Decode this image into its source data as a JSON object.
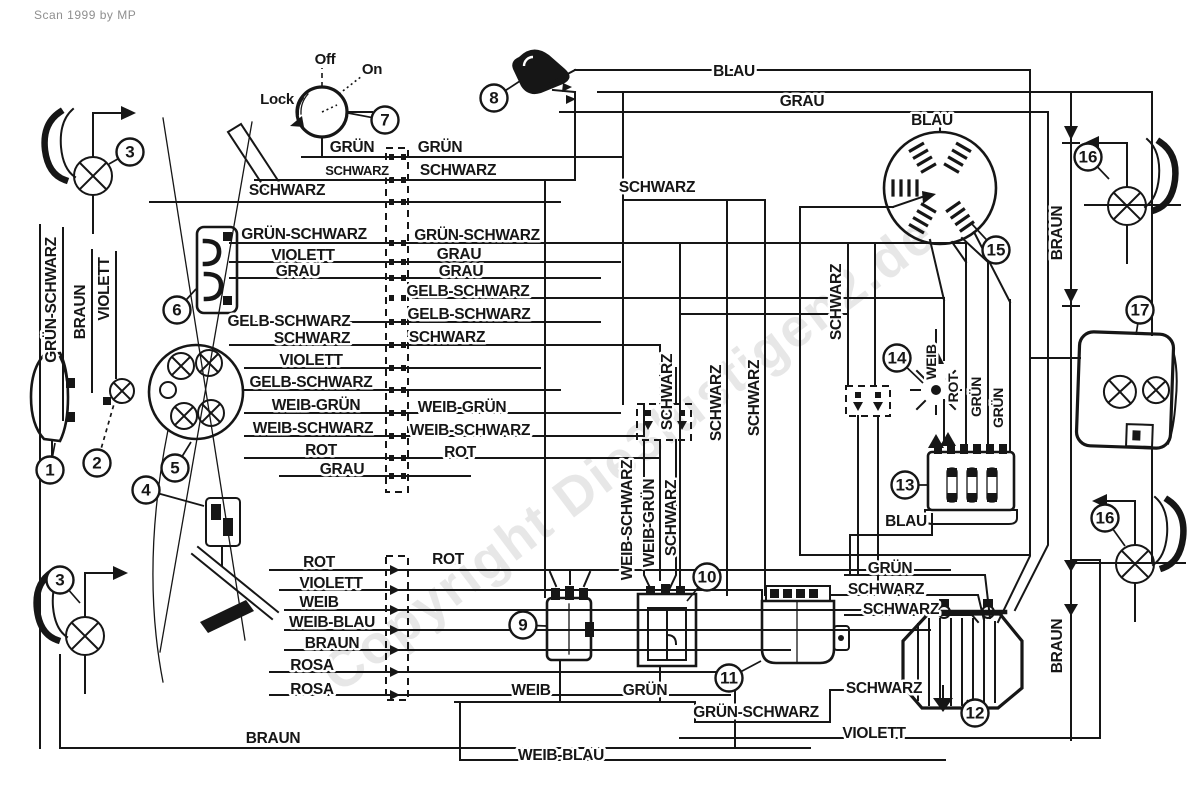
{
  "meta": {
    "credit": "Scan 1999 by MP",
    "watermark": "Copyright Die3lustigen2.de"
  },
  "colors": {
    "ink": "#161616",
    "paper": "#ffffff",
    "watermark": "#bdbdbd"
  },
  "ignition_switch": {
    "positions": [
      "Off",
      "On",
      "Lock"
    ]
  },
  "labels": [
    {
      "text": "Off",
      "x": 325,
      "y": 64,
      "kind": "switch",
      "fs": 15
    },
    {
      "text": "On",
      "x": 372,
      "y": 74,
      "kind": "switch",
      "fs": 15
    },
    {
      "text": "Lock",
      "x": 277,
      "y": 104,
      "kind": "switch",
      "fs": 15
    },
    {
      "text": "GRÜN",
      "x": 352,
      "y": 152
    },
    {
      "text": "GRÜN",
      "x": 440,
      "y": 152
    },
    {
      "text": "SCHWARZ",
      "x": 357,
      "y": 175,
      "fs": 13
    },
    {
      "text": "SCHWARZ",
      "x": 458,
      "y": 175
    },
    {
      "text": "SCHWARZ",
      "x": 287,
      "y": 195
    },
    {
      "text": "BLAU",
      "x": 734,
      "y": 76
    },
    {
      "text": "GRAU",
      "x": 802,
      "y": 106
    },
    {
      "text": "SCHWARZ",
      "x": 657,
      "y": 192
    },
    {
      "text": "BLAU",
      "x": 932,
      "y": 125
    },
    {
      "text": "GRÜN-SCHWARZ",
      "x": 304,
      "y": 239
    },
    {
      "text": "GRÜN-SCHWARZ",
      "x": 477,
      "y": 240
    },
    {
      "text": "VIOLETT",
      "x": 303,
      "y": 260
    },
    {
      "text": "GRAU",
      "x": 459,
      "y": 259
    },
    {
      "text": "GRAU",
      "x": 298,
      "y": 276
    },
    {
      "text": "GRAU",
      "x": 461,
      "y": 276
    },
    {
      "text": "GELB-SCHWARZ",
      "x": 468,
      "y": 296
    },
    {
      "text": "GELB-SCHWARZ",
      "x": 289,
      "y": 326
    },
    {
      "text": "GELB-SCHWARZ",
      "x": 469,
      "y": 319
    },
    {
      "text": "SCHWARZ",
      "x": 312,
      "y": 343
    },
    {
      "text": "SCHWARZ",
      "x": 447,
      "y": 342
    },
    {
      "text": "VIOLETT",
      "x": 311,
      "y": 365
    },
    {
      "text": "GELB-SCHWARZ",
      "x": 311,
      "y": 387
    },
    {
      "text": "WEIB-GRÜN",
      "x": 316,
      "y": 410
    },
    {
      "text": "WEIB-GRÜN",
      "x": 462,
      "y": 412
    },
    {
      "text": "WEIB-SCHWARZ",
      "x": 313,
      "y": 433
    },
    {
      "text": "WEIB-SCHWARZ",
      "x": 470,
      "y": 435
    },
    {
      "text": "ROT",
      "x": 321,
      "y": 455
    },
    {
      "text": "ROT",
      "x": 460,
      "y": 457
    },
    {
      "text": "GRAU",
      "x": 342,
      "y": 474
    },
    {
      "text": "ROT",
      "x": 319,
      "y": 567
    },
    {
      "text": "ROT",
      "x": 448,
      "y": 564
    },
    {
      "text": "VIOLETT",
      "x": 331,
      "y": 588
    },
    {
      "text": "WEIB",
      "x": 319,
      "y": 607
    },
    {
      "text": "WEIB-BLAU",
      "x": 332,
      "y": 627
    },
    {
      "text": "BRAUN",
      "x": 332,
      "y": 648
    },
    {
      "text": "ROSA",
      "x": 312,
      "y": 670
    },
    {
      "text": "ROSA",
      "x": 312,
      "y": 694
    },
    {
      "text": "BRAUN",
      "x": 273,
      "y": 743
    },
    {
      "text": "WEIB",
      "x": 531,
      "y": 695
    },
    {
      "text": "GRÜN",
      "x": 645,
      "y": 695
    },
    {
      "text": "GRÜN-SCHWARZ",
      "x": 756,
      "y": 717
    },
    {
      "text": "WEIB-BLAU",
      "x": 561,
      "y": 760
    },
    {
      "text": "GRÜN",
      "x": 890,
      "y": 573
    },
    {
      "text": "SCHWARZ",
      "x": 886,
      "y": 594
    },
    {
      "text": "SCHWARZ",
      "x": 901,
      "y": 614
    },
    {
      "text": "SCHWARZ",
      "x": 884,
      "y": 693
    },
    {
      "text": "VIOLETT",
      "x": 874,
      "y": 738
    },
    {
      "text": "BLAU",
      "x": 906,
      "y": 526
    },
    {
      "text": "GRÜN-SCHWARZ",
      "x": 56,
      "y": 300,
      "r": -90
    },
    {
      "text": "BRAUN",
      "x": 85,
      "y": 312,
      "r": -90
    },
    {
      "text": "VIOLETT",
      "x": 109,
      "y": 289,
      "r": -90
    },
    {
      "text": "SCHWARZ",
      "x": 672,
      "y": 392,
      "r": -90
    },
    {
      "text": "WEIB-SCHWARZ",
      "x": 632,
      "y": 520,
      "r": -90
    },
    {
      "text": "WEIB-GRÜN",
      "x": 654,
      "y": 523,
      "r": -90
    },
    {
      "text": "SCHWARZ",
      "x": 676,
      "y": 518,
      "r": -90
    },
    {
      "text": "SCHWARZ",
      "x": 721,
      "y": 403,
      "r": -90
    },
    {
      "text": "SCHWARZ",
      "x": 759,
      "y": 398,
      "r": -90
    },
    {
      "text": "SCHWARZ",
      "x": 841,
      "y": 302,
      "r": -90
    },
    {
      "text": "WEIB",
      "x": 936,
      "y": 362,
      "r": -90,
      "fs": 14
    },
    {
      "text": "ROT",
      "x": 958,
      "y": 388,
      "r": -90,
      "fs": 14
    },
    {
      "text": "GRÜN",
      "x": 981,
      "y": 397,
      "r": -90,
      "fs": 14
    },
    {
      "text": "GRÜN",
      "x": 1003,
      "y": 408,
      "r": -90,
      "fs": 14
    },
    {
      "text": "BRAUN",
      "x": 1062,
      "y": 233,
      "r": -90
    },
    {
      "text": "BRAUN",
      "x": 1062,
      "y": 646,
      "r": -90
    }
  ],
  "callouts": [
    {
      "n": "1",
      "x": 50,
      "y": 470,
      "lx": 55,
      "ly": 443
    },
    {
      "n": "2",
      "x": 97,
      "y": 463,
      "lx": 114,
      "ly": 404,
      "dash": true
    },
    {
      "n": "3",
      "x": 130,
      "y": 152,
      "lx": 109,
      "ly": 164
    },
    {
      "n": "3",
      "x": 60,
      "y": 580,
      "lx": 80,
      "ly": 603
    },
    {
      "n": "4",
      "x": 146,
      "y": 490,
      "lx": 204,
      "ly": 506
    },
    {
      "n": "5",
      "x": 175,
      "y": 468,
      "lx": 191,
      "ly": 442
    },
    {
      "n": "6",
      "x": 177,
      "y": 310,
      "lx": 196,
      "ly": 289
    },
    {
      "n": "7",
      "x": 385,
      "y": 120,
      "lx": 348,
      "ly": 113
    },
    {
      "n": "8",
      "x": 494,
      "y": 98,
      "lx": 520,
      "ly": 81
    },
    {
      "n": "9",
      "x": 523,
      "y": 625,
      "lx": 546,
      "ly": 626
    },
    {
      "n": "10",
      "x": 707,
      "y": 577,
      "lx": 687,
      "ly": 601
    },
    {
      "n": "11",
      "x": 729,
      "y": 678,
      "lx": 761,
      "ly": 661
    },
    {
      "n": "12",
      "x": 975,
      "y": 713,
      "lx": 967,
      "ly": 700
    },
    {
      "n": "13",
      "x": 905,
      "y": 485,
      "lx": 927,
      "ly": 485
    },
    {
      "n": "14",
      "x": 897,
      "y": 358,
      "lx": 923,
      "ly": 383
    },
    {
      "n": "15",
      "x": 996,
      "y": 250,
      "lx": 971,
      "ly": 223
    },
    {
      "n": "16",
      "x": 1088,
      "y": 157,
      "lx": 1109,
      "ly": 179
    },
    {
      "n": "16",
      "x": 1105,
      "y": 518,
      "lx": 1125,
      "ly": 546
    },
    {
      "n": "17",
      "x": 1140,
      "y": 310,
      "lx": 1136,
      "ly": 335
    }
  ]
}
